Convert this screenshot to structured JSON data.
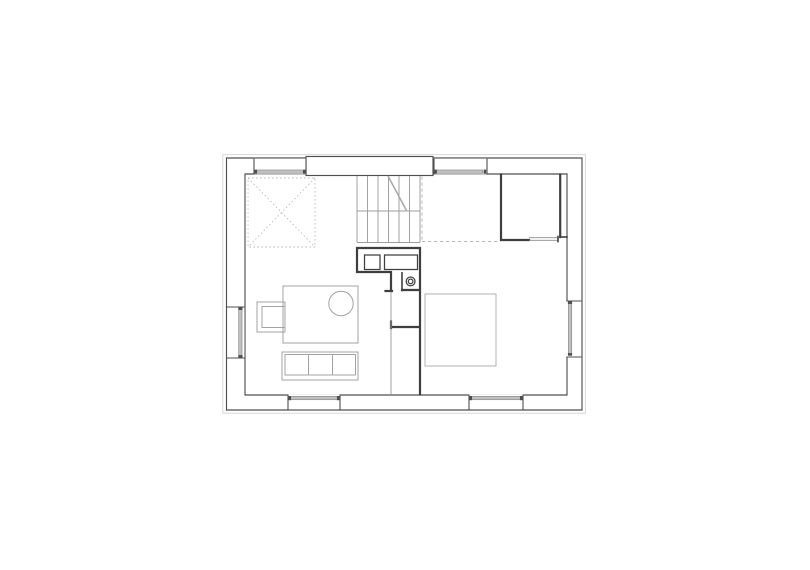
{
  "canvas": {
    "width": 810,
    "height": 570,
    "background": "#ffffff"
  },
  "drawing": {
    "kind": "architectural floor plan",
    "window_count": 6
  },
  "colors": {
    "bg": "#ffffff",
    "eaves": "#d9d9d9",
    "wall-stroke": "#4f4f4f",
    "wall-fill": "#ffffff",
    "glazing-fill": "#c0c0c0",
    "glazing-stroke": "#8c8c8c",
    "partition": "#3f3f3f",
    "fixture": "#3f3f3f",
    "thin-line": "#9b9b9b",
    "stair-line": "#9e9e9e",
    "break-line": "#a8a8a8",
    "dashed-line": "#b8b8b8",
    "dotted-line": "#bdbdbd",
    "furniture": "#a3a3a3",
    "bed-line": "#b3b3b3"
  },
  "inventory": {
    "structure": [
      "exterior-wall-band",
      "top-wall-pier",
      "eaves-outline"
    ],
    "windows": [
      "top-left",
      "top-right",
      "left",
      "right",
      "bottom-left",
      "bottom-right"
    ],
    "circulation": [
      "staircase",
      "stair-break-line",
      "void-opening-dashed",
      "void-cross-square"
    ],
    "core": [
      "shower-square",
      "counter",
      "toilet-basin",
      "wardrobe-niche"
    ],
    "rooms": [
      "closet-room-with-door-opening"
    ],
    "furniture": [
      "rug",
      "round-table",
      "armchair",
      "three-seat-sofa",
      "double-bed"
    ]
  }
}
